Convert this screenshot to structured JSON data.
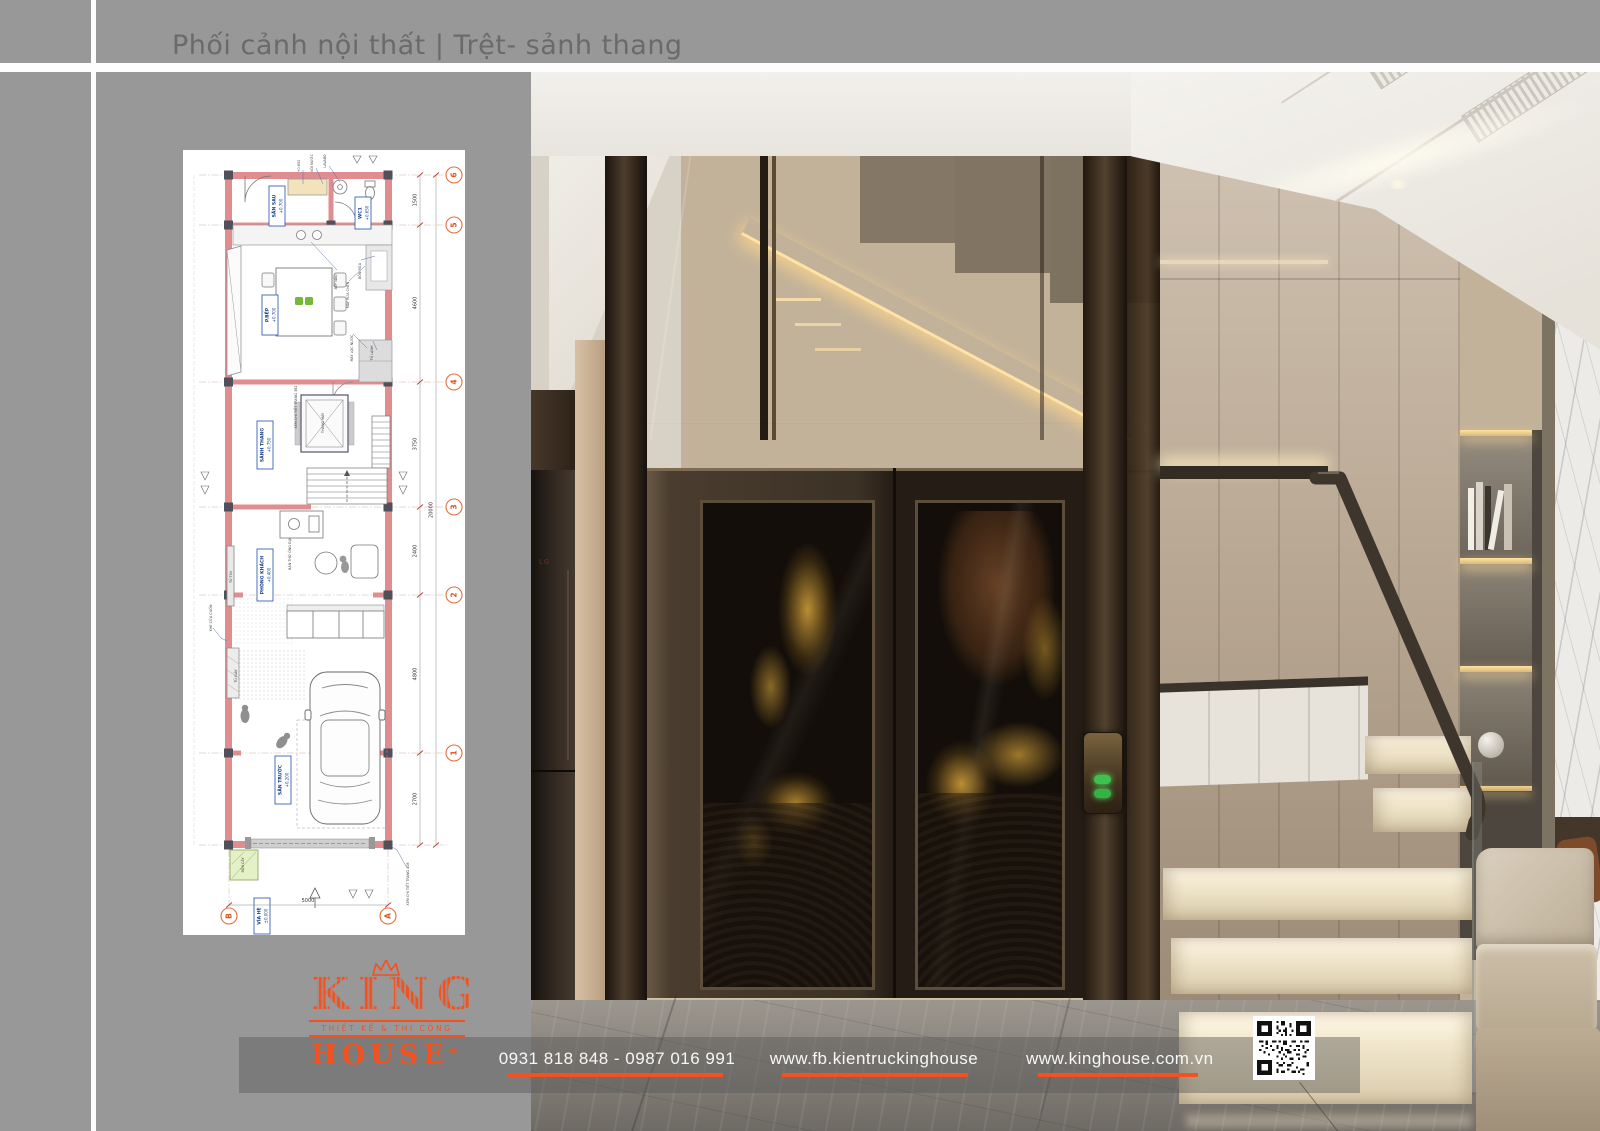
{
  "header": {
    "title": "Phối cảnh nội thất | Trệt- sảnh thang"
  },
  "logo": {
    "brand_top": "KING",
    "tagline": "THIẾT KẾ & THI CÔNG",
    "brand_bottom": "HOUSE",
    "registered": "®"
  },
  "footer": {
    "phone": "0931 818 848 - 0987 016 991",
    "facebook": "www.fb.kientruckinghouse",
    "website": "www.kinghouse.com.vn"
  },
  "render": {
    "appliance_logo": "LG"
  },
  "colors": {
    "accent_orange": "#f4511e",
    "page_gray": "#989898",
    "plan_wall_pink": "#e08d8f",
    "grid_bubble_orange": "#d8551c"
  },
  "floor_plan": {
    "rooms": [
      {
        "name": "SÂN SAU",
        "level": "+0.700"
      },
      {
        "name": "WC1",
        "level": "+0.650"
      },
      {
        "name": "P.BẾP",
        "level": "+0.700"
      },
      {
        "name": "SẢNH THANG",
        "level": "+0.750"
      },
      {
        "name": "PHÒNG KHÁCH",
        "level": "+0.400"
      },
      {
        "name": "SÂN TRƯỚC",
        "level": "+0.200"
      },
      {
        "name": "VỈA HÈ",
        "level": "±0.000"
      }
    ],
    "annotations": {
      "level_top": "+0.650",
      "voi_nuoc": "VÒI NƯỚC",
      "lavabo": "LAVABO",
      "bep_nau": "BẾP NẤU",
      "may_rua_chen": "MÁY RỬA CHÉN",
      "bon_rua": "BỒN RỬA",
      "may_loc_nuoc": "MÁY LỌC NƯỚC",
      "tu_lanh": "TỦ LẠNH",
      "thang_may": "THANG MÁY",
      "xem_382": "XEM CHI TIẾT TRANG 382",
      "ban_tho": "BÀN THỜ ÔNG ĐỊA",
      "tu_tivi": "TỦ TIVI",
      "khe_cua_cuon": "KHE CỬA CUỐN",
      "tu_giay": "TỦ GIÀY",
      "bon_cay": "BỒN CÂY",
      "xem_408": "XEM CHI TIẾT TRANG 408"
    },
    "grid_rows": [
      "6",
      "5",
      "4",
      "3",
      "2",
      "1"
    ],
    "grid_cols": [
      "B",
      "A"
    ],
    "dims_right": [
      "1500",
      "4600",
      "3750",
      "2400",
      "4800",
      "2700"
    ],
    "dim_total": "20000",
    "dim_front_width": "5000"
  }
}
